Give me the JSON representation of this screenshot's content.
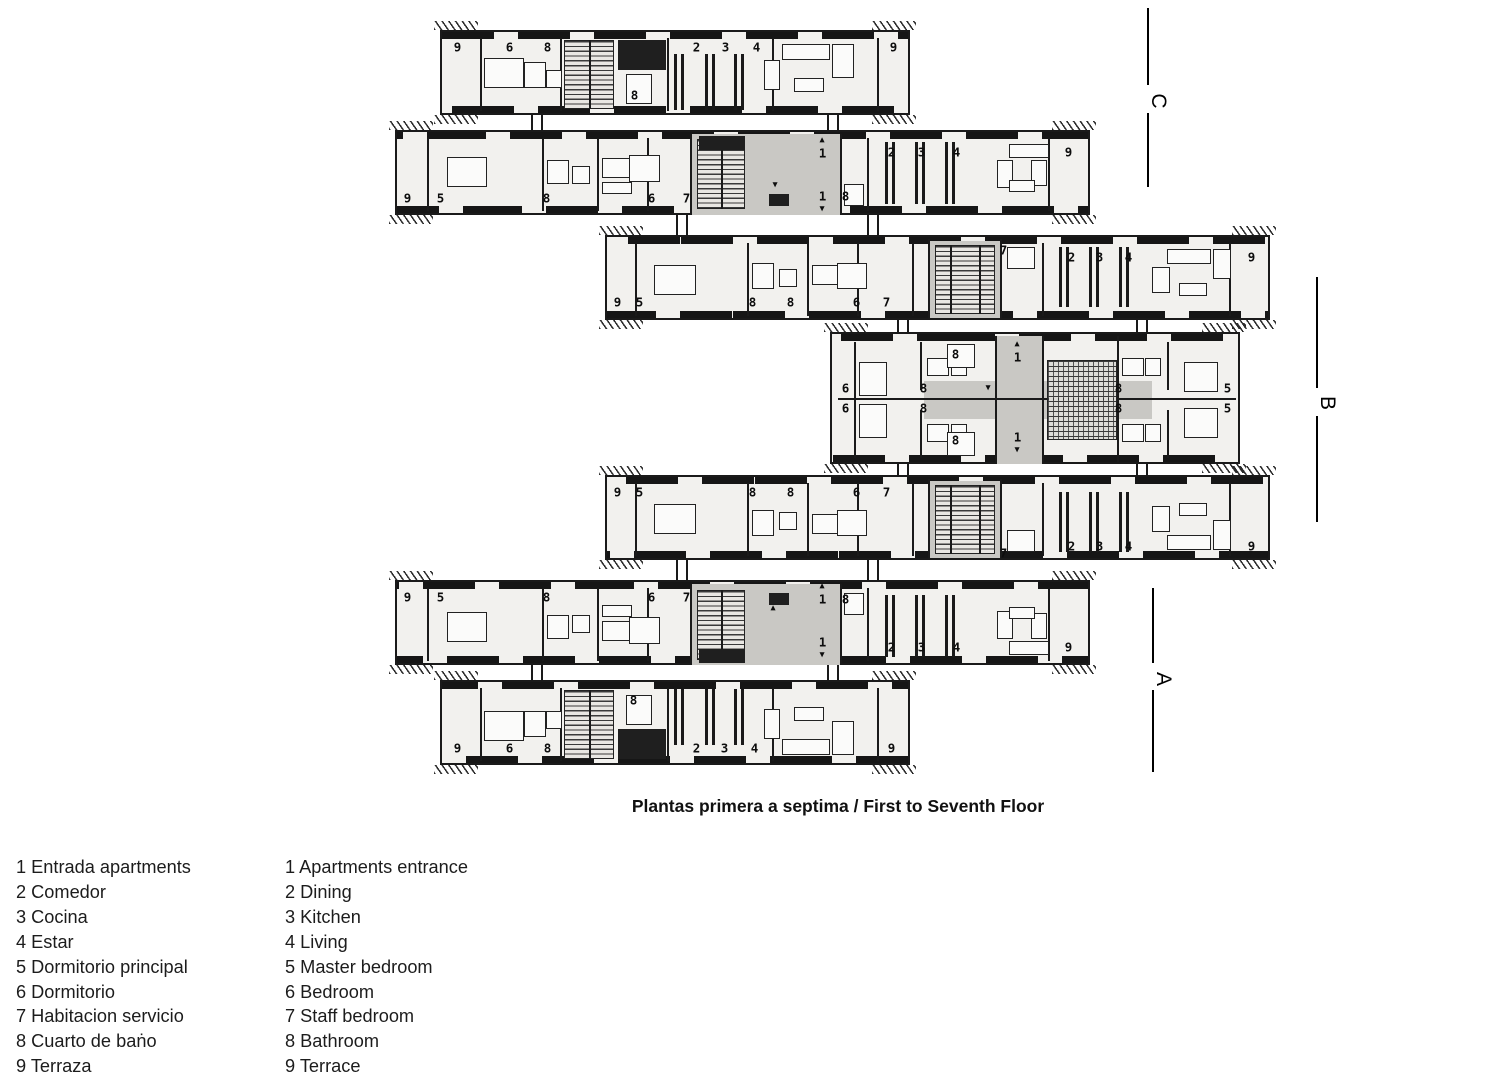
{
  "caption": {
    "text": "Plantas primera a septima / First to Seventh Floor"
  },
  "section_markers": [
    {
      "label": "C",
      "x": 1147,
      "seg1": [
        8,
        85
      ],
      "seg2": [
        113,
        187
      ],
      "letter": [
        1145,
        88
      ]
    },
    {
      "label": "B",
      "x": 1316,
      "seg1": [
        277,
        388
      ],
      "seg2": [
        416,
        522
      ],
      "letter": [
        1314,
        390
      ]
    },
    {
      "label": "A",
      "x": 1152,
      "seg1": [
        588,
        663
      ],
      "seg2": [
        690,
        772
      ],
      "letter": [
        1150,
        666
      ]
    }
  ],
  "legend": {
    "spanish": [
      "1 Entrada apartments",
      "2 Comedor",
      "3 Cocina",
      "4 Estar",
      "5 Dormitorio principal",
      "6 Dormitorio",
      "7 Habitacion servicio",
      "8 Cuarto de baṅo",
      "9 Terraza"
    ],
    "english": [
      "1 Apartments entrance",
      "2 Dining",
      "3 Kitchen",
      "4 Living",
      "5 Master bedroom",
      "6 Bedroom",
      "7 Staff bedroom",
      "8 Bathroom",
      "9 Terrace"
    ]
  },
  "plan": {
    "blocks": [
      {
        "name": "wing-top",
        "x": 440,
        "y": 30,
        "w": 470,
        "h": 85,
        "labels": [
          [
            "9",
            457,
            47
          ],
          [
            "6",
            509,
            47
          ],
          [
            "8",
            547,
            47
          ],
          [
            "8",
            634,
            95
          ],
          [
            "2",
            696,
            47
          ],
          [
            "3",
            725,
            47
          ],
          [
            "4",
            756,
            47
          ],
          [
            "9",
            893,
            47
          ]
        ]
      },
      {
        "name": "wing-upper",
        "x": 395,
        "y": 130,
        "w": 695,
        "h": 85,
        "labels": [
          [
            "9",
            407,
            198
          ],
          [
            "5",
            440,
            198
          ],
          [
            "8",
            546,
            198
          ],
          [
            "6",
            651,
            198
          ],
          [
            "7",
            686,
            198
          ],
          [
            "▲",
            822,
            140
          ],
          [
            "1",
            822,
            153
          ],
          [
            "1",
            822,
            196
          ],
          [
            "▼",
            822,
            209
          ],
          [
            "▼",
            775,
            185
          ],
          [
            "8",
            845,
            196
          ],
          [
            "2",
            891,
            152
          ],
          [
            "3",
            921,
            152
          ],
          [
            "4",
            956,
            152
          ],
          [
            "9",
            1068,
            152
          ]
        ]
      },
      {
        "name": "wing-upper-mid",
        "x": 605,
        "y": 235,
        "w": 665,
        "h": 85,
        "labels": [
          [
            "9",
            617,
            302
          ],
          [
            "5",
            639,
            302
          ],
          [
            "8",
            752,
            302
          ],
          [
            "8",
            790,
            302
          ],
          [
            "6",
            856,
            302
          ],
          [
            "7",
            886,
            302
          ],
          [
            "7",
            1003,
            250
          ],
          [
            "2",
            1071,
            257
          ],
          [
            "3",
            1099,
            257
          ],
          [
            "4",
            1128,
            257
          ],
          [
            "9",
            1251,
            257
          ]
        ]
      },
      {
        "name": "wing-center",
        "x": 830,
        "y": 332,
        "w": 410,
        "h": 132,
        "labels": [
          [
            "6",
            845,
            388
          ],
          [
            "6",
            845,
            408
          ],
          [
            "8",
            923,
            388
          ],
          [
            "8",
            923,
            408
          ],
          [
            "8",
            955,
            354
          ],
          [
            "8",
            955,
            440
          ],
          [
            "▲",
            1017,
            344
          ],
          [
            "1",
            1017,
            357
          ],
          [
            "1",
            1017,
            437
          ],
          [
            "▼",
            1017,
            450
          ],
          [
            "▼",
            988,
            388
          ],
          [
            "8",
            1118,
            388
          ],
          [
            "8",
            1118,
            408
          ],
          [
            "5",
            1227,
            388
          ],
          [
            "5",
            1227,
            408
          ]
        ]
      },
      {
        "name": "wing-lower-mid",
        "x": 605,
        "y": 475,
        "w": 665,
        "h": 85,
        "labels": [
          [
            "9",
            617,
            492
          ],
          [
            "5",
            639,
            492
          ],
          [
            "8",
            752,
            492
          ],
          [
            "8",
            790,
            492
          ],
          [
            "6",
            856,
            492
          ],
          [
            "7",
            886,
            492
          ],
          [
            "7",
            1003,
            553
          ],
          [
            "2",
            1071,
            546
          ],
          [
            "3",
            1099,
            546
          ],
          [
            "4",
            1128,
            546
          ],
          [
            "9",
            1251,
            546
          ]
        ]
      },
      {
        "name": "wing-lower",
        "x": 395,
        "y": 580,
        "w": 695,
        "h": 85,
        "labels": [
          [
            "9",
            407,
            597
          ],
          [
            "5",
            440,
            597
          ],
          [
            "8",
            546,
            597
          ],
          [
            "6",
            651,
            597
          ],
          [
            "7",
            686,
            597
          ],
          [
            "▲",
            822,
            586
          ],
          [
            "1",
            822,
            599
          ],
          [
            "1",
            822,
            642
          ],
          [
            "▼",
            822,
            655
          ],
          [
            "▲",
            773,
            608
          ],
          [
            "8",
            845,
            599
          ],
          [
            "2",
            891,
            647
          ],
          [
            "3",
            921,
            647
          ],
          [
            "4",
            956,
            647
          ],
          [
            "9",
            1068,
            647
          ]
        ]
      },
      {
        "name": "wing-bottom",
        "x": 440,
        "y": 680,
        "w": 470,
        "h": 85,
        "labels": [
          [
            "9",
            457,
            748
          ],
          [
            "6",
            509,
            748
          ],
          [
            "8",
            547,
            748
          ],
          [
            "8",
            633,
            700
          ],
          [
            "2",
            696,
            748
          ],
          [
            "3",
            724,
            748
          ],
          [
            "4",
            754,
            748
          ],
          [
            "9",
            891,
            748
          ]
        ]
      }
    ],
    "connectors": [
      [
        537,
        115,
        15
      ],
      [
        833,
        115,
        15
      ],
      [
        682,
        215,
        20
      ],
      [
        873,
        215,
        20
      ],
      [
        903,
        320,
        12
      ],
      [
        1142,
        320,
        12
      ],
      [
        903,
        464,
        11
      ],
      [
        1142,
        464,
        11
      ],
      [
        682,
        560,
        20
      ],
      [
        873,
        560,
        20
      ],
      [
        537,
        665,
        15
      ],
      [
        833,
        665,
        15
      ]
    ]
  }
}
